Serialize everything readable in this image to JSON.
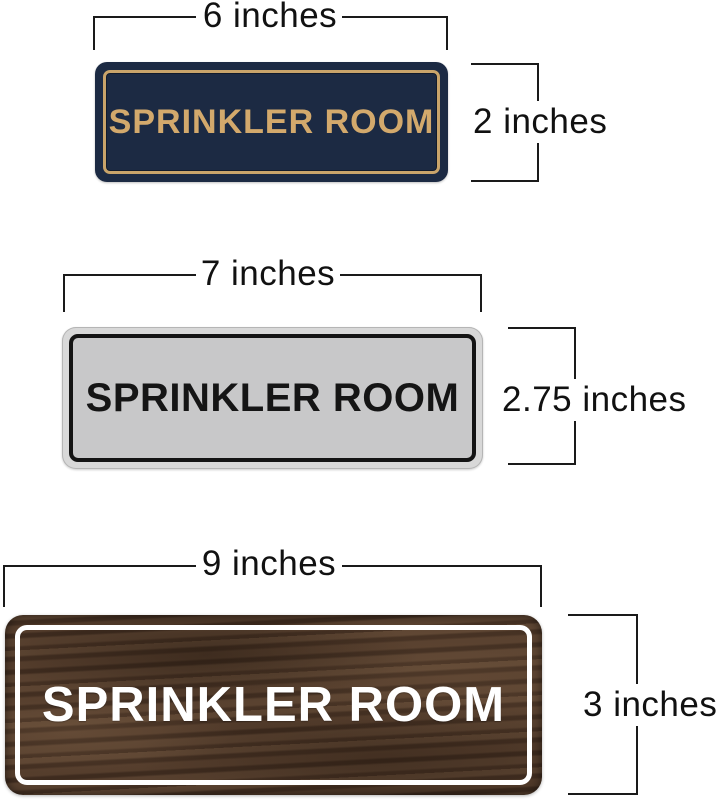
{
  "canvas_background": "#ffffff",
  "dimension_line_color": "#1a1a1a",
  "signs": [
    {
      "name": "navy-gold-sign",
      "text": "SPRINKLER ROOM",
      "width_label": "6 inches",
      "height_label": "2 inches",
      "colors": {
        "background": "#1c2a43",
        "frame": "#c9a46a",
        "text": "#d3a96c"
      }
    },
    {
      "name": "silver-black-sign",
      "text": "SPRINKLER ROOM",
      "width_label": "7 inches",
      "height_label": "2.75 inches",
      "colors": {
        "background": "#c8c8c9",
        "rim": "#d8d8d8",
        "frame": "#141414",
        "text": "#151515"
      }
    },
    {
      "name": "walnut-white-sign",
      "text": "SPRINKLER ROOM",
      "width_label": "9 inches",
      "height_label": "3 inches",
      "colors": {
        "background": "#4b3526",
        "frame": "#ffffff",
        "text": "#ffffff"
      }
    }
  ]
}
